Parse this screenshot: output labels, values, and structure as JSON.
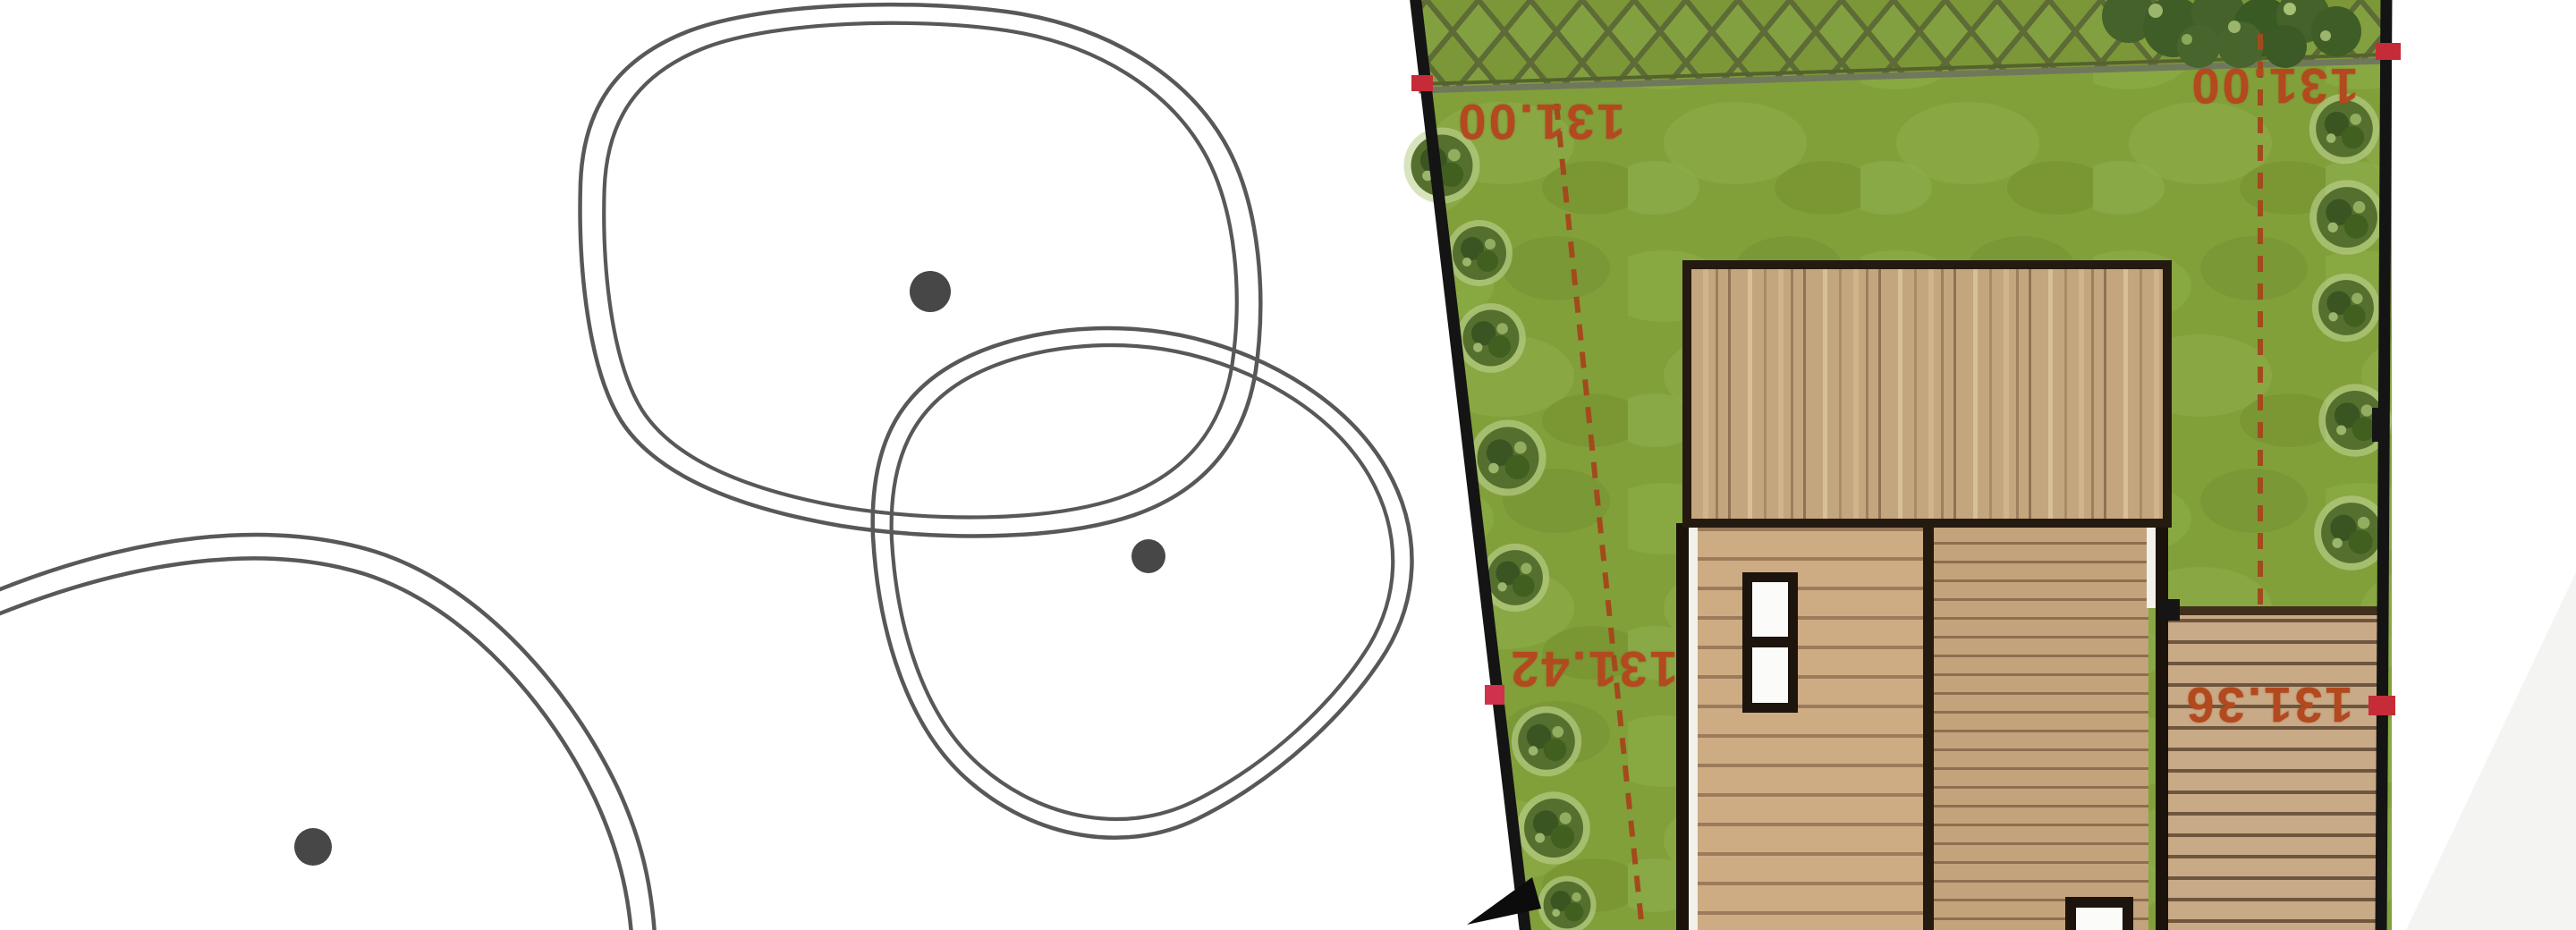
{
  "site_plan": {
    "elevation_labels": [
      {
        "text": "131.00",
        "position": "upper-left-boundary"
      },
      {
        "text": "131.00",
        "position": "upper-right-boundary"
      },
      {
        "text": "131.42",
        "position": "mid-left-boundary"
      },
      {
        "text": "131.36",
        "position": "mid-right-terrace"
      }
    ],
    "colors": {
      "background": "#ffffff",
      "lawn_green": "#82a03a",
      "hedge_line_olive": "#5d6b36",
      "shrub_dark_green": "#44622a",
      "tree_green": "#55702e",
      "canopy_outline_gray": "#585858",
      "boundary_black": "#141414",
      "roof_wood": "#c3a67e",
      "deck_wood": "#cdac84",
      "terrace_wood": "#c9aa86",
      "building_outline": "#241a10",
      "survey_text_red": "#b3491e",
      "survey_dash_red": "#a34a1d",
      "survey_marker_red": "#c62b38"
    }
  }
}
